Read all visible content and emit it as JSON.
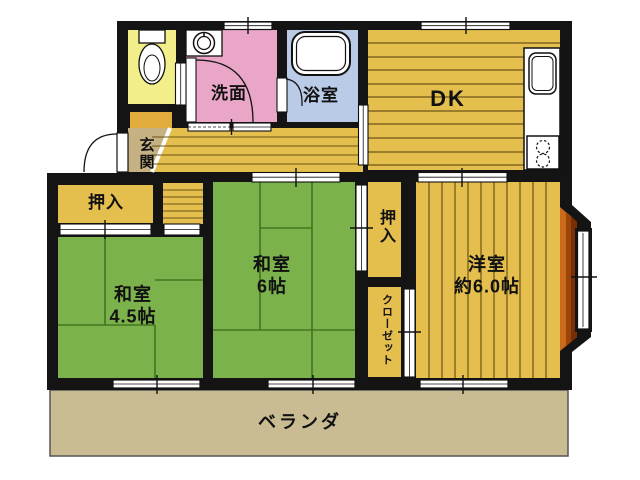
{
  "colors": {
    "wall": "#141414",
    "wood_floor": "#e4bf4e",
    "wood_line": "#6d5414",
    "tatami": "#7cb24c",
    "tatami_line": "#44741f",
    "washroom": "#e9a6c7",
    "bathroom": "#b9cbe6",
    "toilet": "#f2ee8a",
    "entrance": "#c6b183",
    "veranda": "#c9bc93",
    "bay_window": "#cc6a1c",
    "shoe_cabinet": "#e2ab3e",
    "fixture": "#ffffff"
  },
  "rooms": {
    "washroom": {
      "label": "洗面"
    },
    "bathroom": {
      "label": "浴室"
    },
    "dining_kitchen": {
      "label": "DK"
    },
    "entrance": {
      "label": "玄関"
    },
    "closet_left": {
      "label": "押入"
    },
    "japanese_room_4_5": {
      "label": "和室",
      "size": "4.5帖"
    },
    "japanese_room_6": {
      "label": "和室",
      "size": "6帖"
    },
    "closet_right": {
      "label": "押入"
    },
    "closet_western_room": {
      "label": "クローゼット"
    },
    "western_room": {
      "label": "洋室",
      "size": "約6.0帖"
    },
    "veranda": {
      "label": "ベランダ"
    }
  }
}
